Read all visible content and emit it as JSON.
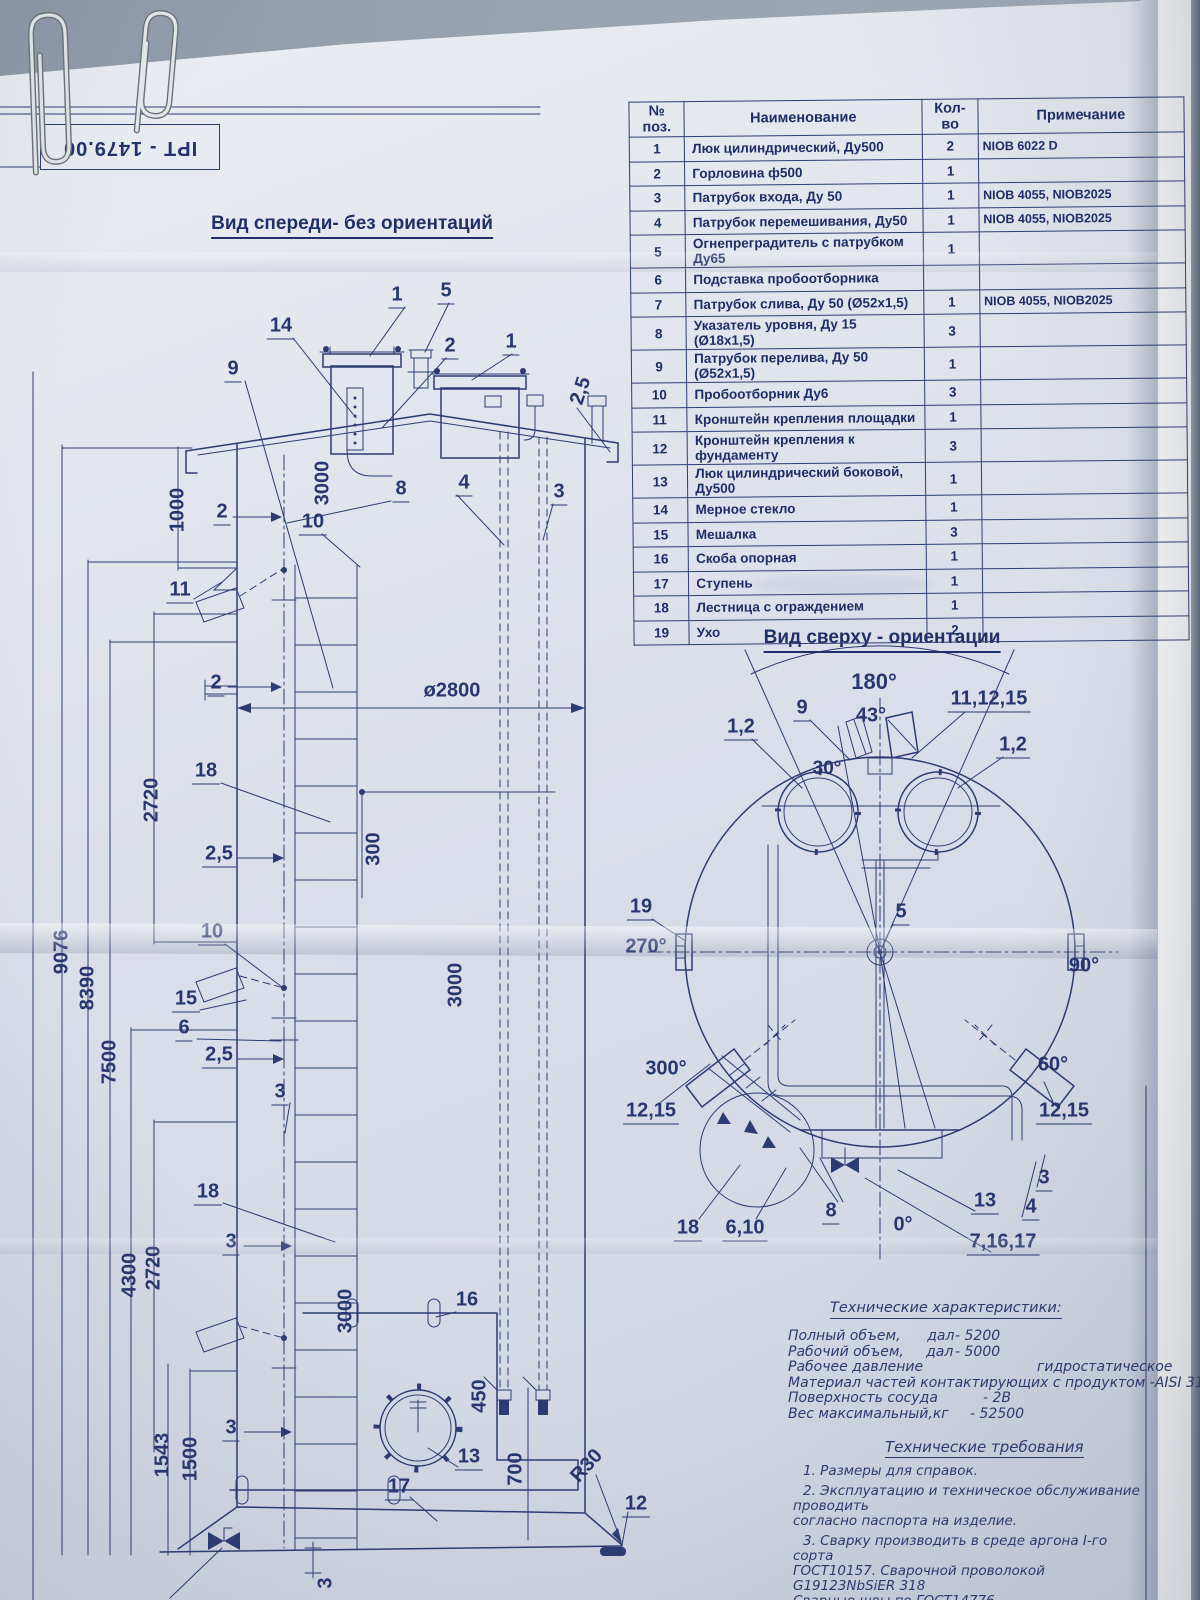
{
  "stamp": {
    "text": "IPT - 1479.00"
  },
  "colors": {
    "ink": "#2c3c72",
    "paper": "#d9dde9",
    "desk": "#8f99a9"
  },
  "parts_table": {
    "headers": {
      "pos": "№ поз.",
      "name": "Наименование",
      "qty": "Кол-во",
      "note": "Примечание"
    },
    "rows": [
      {
        "pos": "1",
        "name": "Люк цилиндрический, Ду500",
        "qty": "2",
        "note": "NIOB 6022 D"
      },
      {
        "pos": "2",
        "name": "Горловина ф500",
        "qty": "1",
        "note": ""
      },
      {
        "pos": "3",
        "name": "Патрубок входа, Ду 50",
        "qty": "1",
        "note": "NIOB 4055, NIOB2025"
      },
      {
        "pos": "4",
        "name": "Патрубок перемешивания, Ду50",
        "qty": "1",
        "note": "NIOB 4055, NIOB2025"
      },
      {
        "pos": "5",
        "name": "Огнепреградитель с патрубком Ду65",
        "qty": "1",
        "note": ""
      },
      {
        "pos": "6",
        "name": "Подставка пробоотборника",
        "qty": "",
        "note": ""
      },
      {
        "pos": "7",
        "name": "Патрубок слива, Ду 50 (Ø52х1,5)",
        "qty": "1",
        "note": "NIOB 4055, NIOB2025"
      },
      {
        "pos": "8",
        "name": "Указатель уровня, Ду 15 (Ø18х1,5)",
        "qty": "3",
        "note": ""
      },
      {
        "pos": "9",
        "name": "Патрубок перелива, Ду 50 (Ø52х1,5)",
        "qty": "1",
        "note": ""
      },
      {
        "pos": "10",
        "name": "Пробоотборник Ду6",
        "qty": "3",
        "note": ""
      },
      {
        "pos": "11",
        "name": "Кронштейн крепления площадки",
        "qty": "1",
        "note": ""
      },
      {
        "pos": "12",
        "name": "Кронштейн крепления к фундаменту",
        "qty": "3",
        "note": ""
      },
      {
        "pos": "13",
        "name": "Люк цилиндрический боковой, Ду500",
        "qty": "1",
        "note": ""
      },
      {
        "pos": "14",
        "name": "Мерное стекло",
        "qty": "1",
        "note": ""
      },
      {
        "pos": "15",
        "name": "Мешалка",
        "qty": "3",
        "note": ""
      },
      {
        "pos": "16",
        "name": "Скоба опорная",
        "qty": "1",
        "note": ""
      },
      {
        "pos": "17",
        "name": "Ступень",
        "qty": "1",
        "note": ""
      },
      {
        "pos": "18",
        "name": "Лестница с ограждением",
        "qty": "1",
        "note": ""
      },
      {
        "pos": "19",
        "name": "Ухо",
        "qty": "2",
        "note": ""
      }
    ]
  },
  "front_view": {
    "title": "Вид спереди- без ориентаций",
    "labels": [
      {
        "t": "14",
        "x": 281,
        "y": 327,
        "u": 1
      },
      {
        "t": "9",
        "x": 233,
        "y": 370,
        "u": 1
      },
      {
        "t": "1",
        "x": 397,
        "y": 296,
        "u": 1
      },
      {
        "t": "5",
        "x": 446,
        "y": 292,
        "u": 1
      },
      {
        "t": "2",
        "x": 450,
        "y": 347,
        "u": 1
      },
      {
        "t": "1",
        "x": 511,
        "y": 343,
        "u": 1
      },
      {
        "t": "2,5",
        "x": 581,
        "y": 391,
        "r": -72
      },
      {
        "t": "8",
        "x": 401,
        "y": 490,
        "u": 1
      },
      {
        "t": "4",
        "x": 464,
        "y": 484,
        "u": 1
      },
      {
        "t": "3",
        "x": 559,
        "y": 493,
        "u": 1
      },
      {
        "t": "1000",
        "x": 178,
        "y": 510,
        "r": -90
      },
      {
        "t": "3000",
        "x": 323,
        "y": 483,
        "r": -90
      },
      {
        "t": "2",
        "x": 222,
        "y": 513,
        "u": 1
      },
      {
        "t": "10",
        "x": 313,
        "y": 523,
        "u": 1
      },
      {
        "t": "11",
        "x": 180,
        "y": 591,
        "u": 1
      },
      {
        "t": "2",
        "x": 216,
        "y": 684,
        "u": 1
      },
      {
        "t": "ø2800",
        "x": 452,
        "y": 691
      },
      {
        "t": "2720",
        "x": 152,
        "y": 800,
        "r": -90
      },
      {
        "t": "18",
        "x": 206,
        "y": 772,
        "u": 1
      },
      {
        "t": "2,5",
        "x": 219,
        "y": 855,
        "u": 1
      },
      {
        "t": "300",
        "x": 374,
        "y": 849,
        "r": -90
      },
      {
        "t": "9076",
        "x": 62,
        "y": 952,
        "r": -90
      },
      {
        "t": "8390",
        "x": 88,
        "y": 988,
        "r": -90
      },
      {
        "t": "7500",
        "x": 110,
        "y": 1062,
        "r": -90
      },
      {
        "t": "10",
        "x": 212,
        "y": 933,
        "u": 1
      },
      {
        "t": "15",
        "x": 186,
        "y": 1000,
        "u": 1
      },
      {
        "t": "6",
        "x": 184,
        "y": 1029,
        "u": 1
      },
      {
        "t": "2,5",
        "x": 219,
        "y": 1056,
        "u": 1
      },
      {
        "t": "3",
        "x": 280,
        "y": 1093,
        "u": 1
      },
      {
        "t": "3000",
        "x": 456,
        "y": 985,
        "r": -90
      },
      {
        "t": "2720",
        "x": 154,
        "y": 1268,
        "r": -90
      },
      {
        "t": "4300",
        "x": 130,
        "y": 1275,
        "r": -90
      },
      {
        "t": "18",
        "x": 208,
        "y": 1193,
        "u": 1
      },
      {
        "t": "3",
        "x": 231,
        "y": 1243,
        "u": 1
      },
      {
        "t": "3000",
        "x": 346,
        "y": 1311,
        "r": -90
      },
      {
        "t": "16",
        "x": 467,
        "y": 1301,
        "u": 1
      },
      {
        "t": "1543",
        "x": 163,
        "y": 1455,
        "r": -90
      },
      {
        "t": "1500",
        "x": 191,
        "y": 1459,
        "r": -90
      },
      {
        "t": "3",
        "x": 231,
        "y": 1429,
        "u": 1
      },
      {
        "t": "450",
        "x": 480,
        "y": 1396,
        "r": -90
      },
      {
        "t": "13",
        "x": 469,
        "y": 1458,
        "u": 1
      },
      {
        "t": "700",
        "x": 516,
        "y": 1469,
        "r": -90
      },
      {
        "t": "17",
        "x": 399,
        "y": 1488,
        "u": 1
      },
      {
        "t": "R30",
        "x": 587,
        "y": 1466,
        "r": -48
      },
      {
        "t": "12",
        "x": 636,
        "y": 1505,
        "u": 1
      },
      {
        "t": "3",
        "x": 326,
        "y": 1583,
        "r": -90
      }
    ]
  },
  "top_view": {
    "title": "Вид сверху - ориентации",
    "labels": [
      {
        "t": "180°",
        "x": 874,
        "y": 682,
        "fs": 22
      },
      {
        "t": "43°",
        "x": 871,
        "y": 716,
        "fs": 20
      },
      {
        "t": "9",
        "x": 802,
        "y": 709,
        "u": 1
      },
      {
        "t": "11,12,15",
        "x": 989,
        "y": 700,
        "u": 1
      },
      {
        "t": "1,2",
        "x": 741,
        "y": 728,
        "u": 1
      },
      {
        "t": "1,2",
        "x": 1013,
        "y": 746,
        "u": 1
      },
      {
        "t": "30°",
        "x": 827,
        "y": 769,
        "fs": 19
      },
      {
        "t": "19",
        "x": 641,
        "y": 908,
        "u": 1
      },
      {
        "t": "270°",
        "x": 646,
        "y": 947
      },
      {
        "t": "5",
        "x": 901,
        "y": 913,
        "u": 1
      },
      {
        "t": "90°",
        "x": 1084,
        "y": 966
      },
      {
        "t": "300°",
        "x": 666,
        "y": 1069
      },
      {
        "t": "60°",
        "x": 1053,
        "y": 1065
      },
      {
        "t": "12,15",
        "x": 651,
        "y": 1112,
        "u": 1
      },
      {
        "t": "12,15",
        "x": 1064,
        "y": 1112,
        "u": 1
      },
      {
        "t": "18",
        "x": 688,
        "y": 1229,
        "u": 1
      },
      {
        "t": "6,10",
        "x": 745,
        "y": 1229,
        "u": 1
      },
      {
        "t": "8",
        "x": 831,
        "y": 1212,
        "u": 1
      },
      {
        "t": "0°",
        "x": 903,
        "y": 1225
      },
      {
        "t": "13",
        "x": 985,
        "y": 1202,
        "u": 1
      },
      {
        "t": "4",
        "x": 1031,
        "y": 1208,
        "u": 1
      },
      {
        "t": "3",
        "x": 1044,
        "y": 1179,
        "u": 1
      },
      {
        "t": "7,16,17",
        "x": 1003,
        "y": 1243,
        "u": 1
      }
    ]
  },
  "tech_specs": {
    "title": "Технические характеристики:",
    "rows": [
      {
        "name": "Полный объем,      дал",
        "value": "- 5200",
        "vx": 167
      },
      {
        "name": "Рабочий объем,     дал",
        "value": "- 5000",
        "vx": 167
      },
      {
        "name": "Рабочее давление",
        "value": "гидростатическое",
        "vx": 249
      },
      {
        "name": "Материал частей контактирующих с продуктом -AISI 316",
        "value": "",
        "vx": 0
      },
      {
        "name": "Поверхность сосуда",
        "value": "- 2В",
        "vx": 195
      },
      {
        "name": "Вес максимальный,кг",
        "value": "- 52500",
        "vx": 182
      }
    ]
  },
  "tech_reqs": {
    "title": "Технические требования",
    "items": [
      "1. Размеры для справок.",
      "2. Эксплуатацию и техническое обслуживание проводить\nсогласно паспорта на изделие.",
      "3. Сварку производить в среде аргона I-го сорта\nГОСТ10157. Сварочной проволокой G19123NbSiER 318\nСварные швы по ГОСТ14776",
      "4. Сварные швы проверить на герметичность."
    ]
  }
}
